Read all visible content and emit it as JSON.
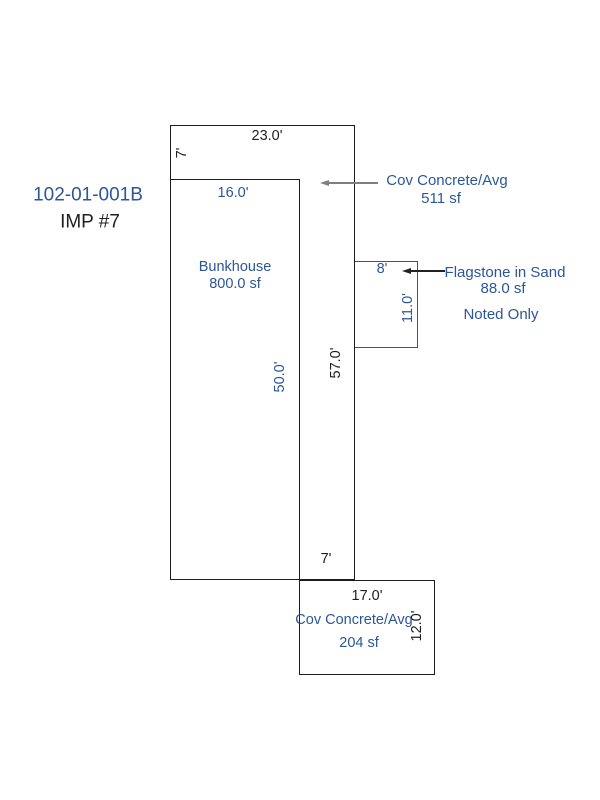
{
  "colors": {
    "annotation_blue": "#2b5797",
    "line_black": "#1c1c1c",
    "text_black": "#1f1f1f",
    "arrow_gray": "#7f7f7f",
    "background": "#ffffff"
  },
  "header": {
    "parcel_id": "102-01-001B",
    "improvement": "IMP #7"
  },
  "shapes": {
    "outer": {
      "dim_top": "23.0'",
      "dim_top_left": "7'",
      "dim_right": "57.0'",
      "dim_bottom": "7'"
    },
    "bunkhouse": {
      "name": "Bunkhouse",
      "area": "800.0 sf",
      "dim_top": "16.0'",
      "dim_right": "50.0'"
    },
    "flagstone": {
      "name": "Flagstone in Sand",
      "area": "88.0 sf",
      "note": "Noted Only",
      "dim_top": "8'",
      "dim_right": "11.0'"
    },
    "cov_concrete_attached": {
      "name": "Cov Concrete/Avg",
      "area": "511 sf"
    },
    "cov_concrete_detached": {
      "name": "Cov Concrete/Avg",
      "area": "204 sf",
      "dim_top": "17.0'",
      "dim_right": "12.0'"
    }
  }
}
